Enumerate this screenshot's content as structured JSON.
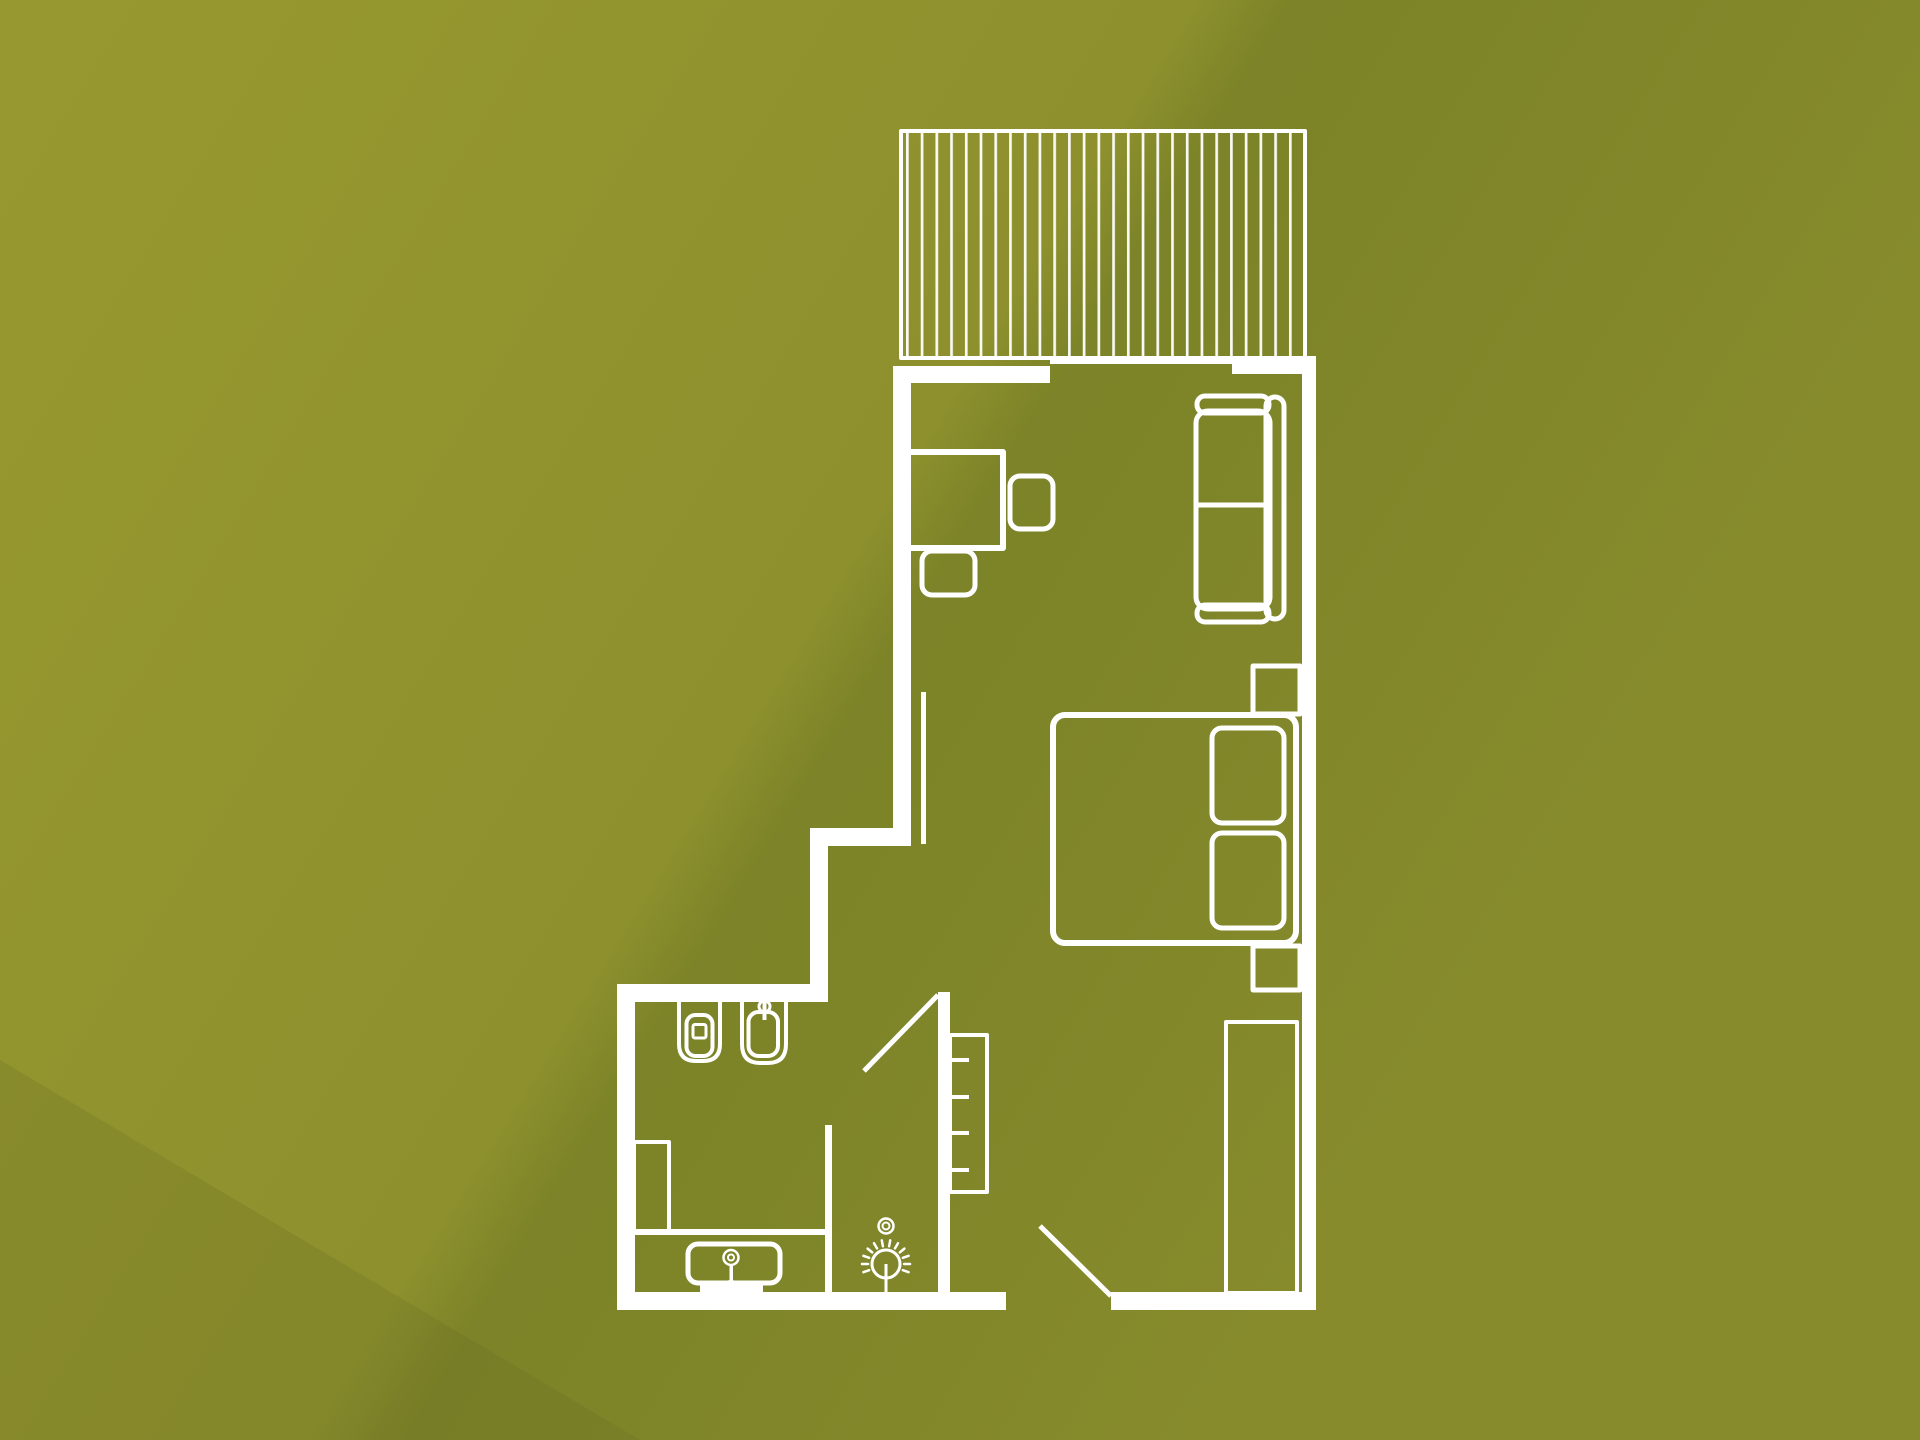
{
  "title": "Apartment floor plan",
  "colors": {
    "line": "#ffffff",
    "background_light": "#97982f",
    "background_mid": "#8d902d",
    "background_shade": "#7c8328",
    "background_right": "#878b2c",
    "corner_shade": "#5c6620"
  },
  "floorplan": {
    "type": "architectural-floor-plan",
    "rooms": [
      {
        "name": "terrace",
        "features": [
          "decking-hatch",
          "sliding-window"
        ]
      },
      {
        "name": "living-bedroom",
        "furniture": [
          "desk",
          "desk-chair",
          "side-chair",
          "two-seat-sofa",
          "double-bed",
          "pillow",
          "pillow",
          "nightstand",
          "nightstand",
          "wardrobe"
        ]
      },
      {
        "name": "bathroom",
        "furniture": [
          "toilet",
          "washbasin",
          "vanity-counter",
          "vanity-basin",
          "tall-cabinet"
        ]
      },
      {
        "name": "hallway",
        "furniture": [
          "towel-radiator",
          "floor-lamp",
          "ceiling-spot"
        ]
      }
    ],
    "doors": [
      "bathroom-door",
      "entry-door"
    ]
  }
}
